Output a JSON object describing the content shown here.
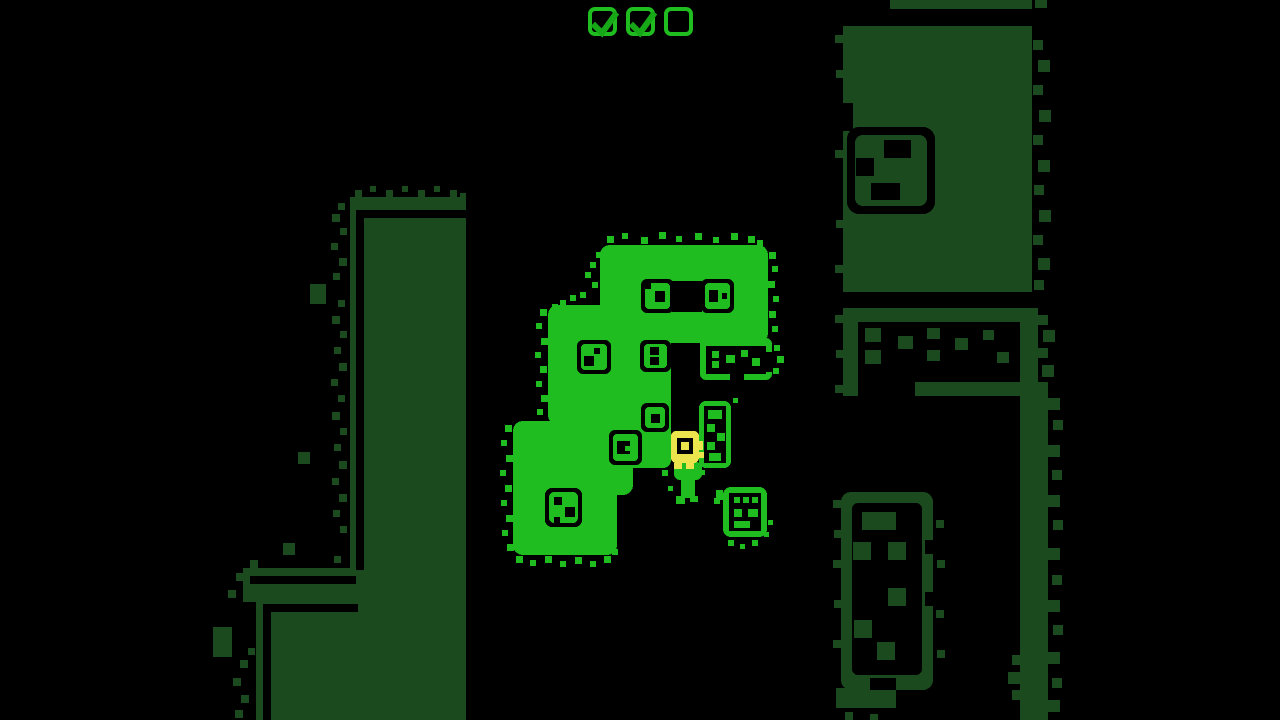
{
  "colors": {
    "background": "#000000",
    "bright": "#20bd20",
    "dim": "#1b4a1e",
    "outline": "#000000",
    "player": "#ece44c",
    "check": "#17a817"
  },
  "hud": {
    "checkboxes": [
      {
        "id": "objective-1",
        "state": "checked"
      },
      {
        "id": "objective-2",
        "state": "checked"
      },
      {
        "id": "objective-3",
        "state": "unchecked"
      }
    ],
    "check_glyph": "checkmark"
  },
  "scene": {
    "viewport": {
      "width": 1280,
      "height": 720
    },
    "player": {
      "present": true,
      "approx_position": {
        "x": 684,
        "y": 447
      }
    },
    "island": {
      "style": "bright-lit",
      "dice_tiles": 7,
      "outline_tiles": [
        "pip-plate",
        "ladder-tile",
        "exit-tile"
      ],
      "sprout": 1
    },
    "dim_regions": [
      "left-column",
      "bottom-left-block",
      "top-right-block",
      "mid-right-band",
      "right-edge-column",
      "bottom-right-domino"
    ]
  }
}
